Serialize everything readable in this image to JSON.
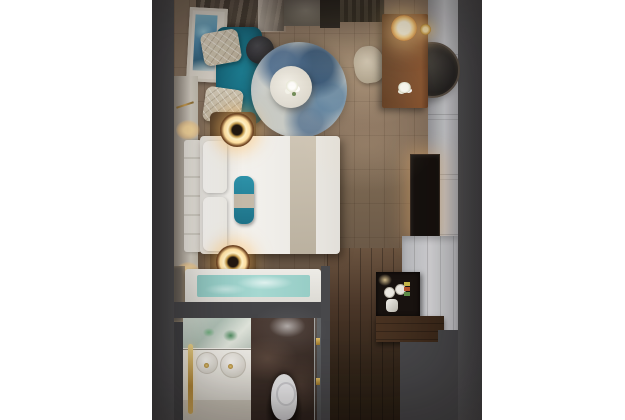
{
  "scene": {
    "description": "Top-down 3D interior render of a compact hotel guest room with bedroom, work desk, bathroom and entry corridor, centered on a white background",
    "rooms": [
      "bedroom",
      "bathroom",
      "entry-corridor"
    ],
    "objects": [
      "window-curtains",
      "framed-artwork",
      "teal-sofa",
      "patterned-throw-pillows",
      "charcoal-side-stool",
      "round-blue-rug",
      "white-coffee-table",
      "flower-vase",
      "wood-work-desk",
      "glowing-desk-lamp",
      "gold-wall-sconce",
      "desk-chair",
      "round-wall-mirror",
      "double-bed",
      "white-bed-pillows",
      "teal-accent-pillow",
      "beige-bed-runner",
      "tufted-headboard",
      "nightstands-with-ring-lamps",
      "headboard-wall-sconces",
      "wall-mounted-tv",
      "wardrobe-panels",
      "minibar-cabinet-with-cups-and-kettle",
      "dark-wood-console",
      "bathtub-with-water",
      "vanity-with-two-sinks",
      "gold-towel-rail",
      "marble-toilet-niche",
      "toilet",
      "glass-shower-door",
      "wood-plank-floor"
    ]
  },
  "colors": {
    "canvas-bg": "#ffffff",
    "wall-gray": "#48484b",
    "wall-light": "#cccdd1",
    "floor-wood": "#8a7663",
    "corridor-wood": "#3a2b1e",
    "sofa-teal": "#1d7e92",
    "pillow-cream": "#cfc5b1",
    "rug-blue": "#416d97",
    "rug-pale": "#d6d8d3",
    "bed-white": "#f4f2ee",
    "runner-beige": "#c4baa9",
    "accent-teal": "#2b8ca3",
    "headboard-cream": "#e9e5dd",
    "gold": "#cfa254",
    "lamp-glow": "#ffd99c",
    "desk-wood": "#74482a",
    "tv-black": "#16110e",
    "tub-water": "#a6d8d1",
    "marble-brown": "#3a2d27",
    "porcelain": "#f1f1f2",
    "chair-beige": "#c8bdac"
  }
}
